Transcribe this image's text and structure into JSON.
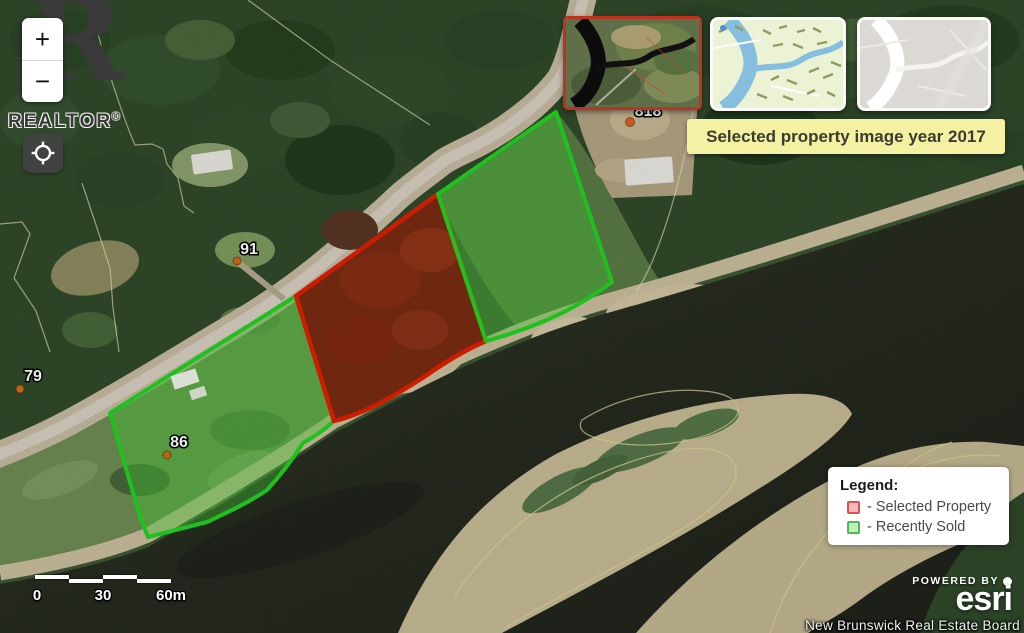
{
  "banner": {
    "text": "Selected property image year 2017"
  },
  "legend": {
    "title": "Legend:",
    "items": [
      {
        "label": "- Selected Property",
        "swatch_fill": "#f8b7bb",
        "swatch_border": "#d9534f"
      },
      {
        "label": "- Recently Sold",
        "swatch_fill": "#baf2b5",
        "swatch_border": "#56b456"
      }
    ]
  },
  "map": {
    "address_labels": [
      {
        "text": "91"
      },
      {
        "text": "79"
      },
      {
        "text": "86"
      },
      {
        "text": "818"
      }
    ],
    "parcel_colors": {
      "selected_stroke": "#df1f00",
      "sold_stroke": "#22d122"
    },
    "marker_color": "#d06a1d"
  },
  "controls": {
    "zoom_in": "+",
    "zoom_out": "−",
    "brand_initial": "R",
    "brand": "REALTOR",
    "brand_reg": "®",
    "basemap_options": [
      {
        "name": "satellite-imagery-2017",
        "selected": true
      },
      {
        "name": "street-map",
        "selected": false
      },
      {
        "name": "light-gray-canvas",
        "selected": false
      }
    ]
  },
  "scale_bar": {
    "labels": [
      "0",
      "30",
      "60m"
    ]
  },
  "attribution": {
    "powered_by": "POWERED BY",
    "brand": "esri",
    "board": "New Brunswick Real Estate Board"
  }
}
